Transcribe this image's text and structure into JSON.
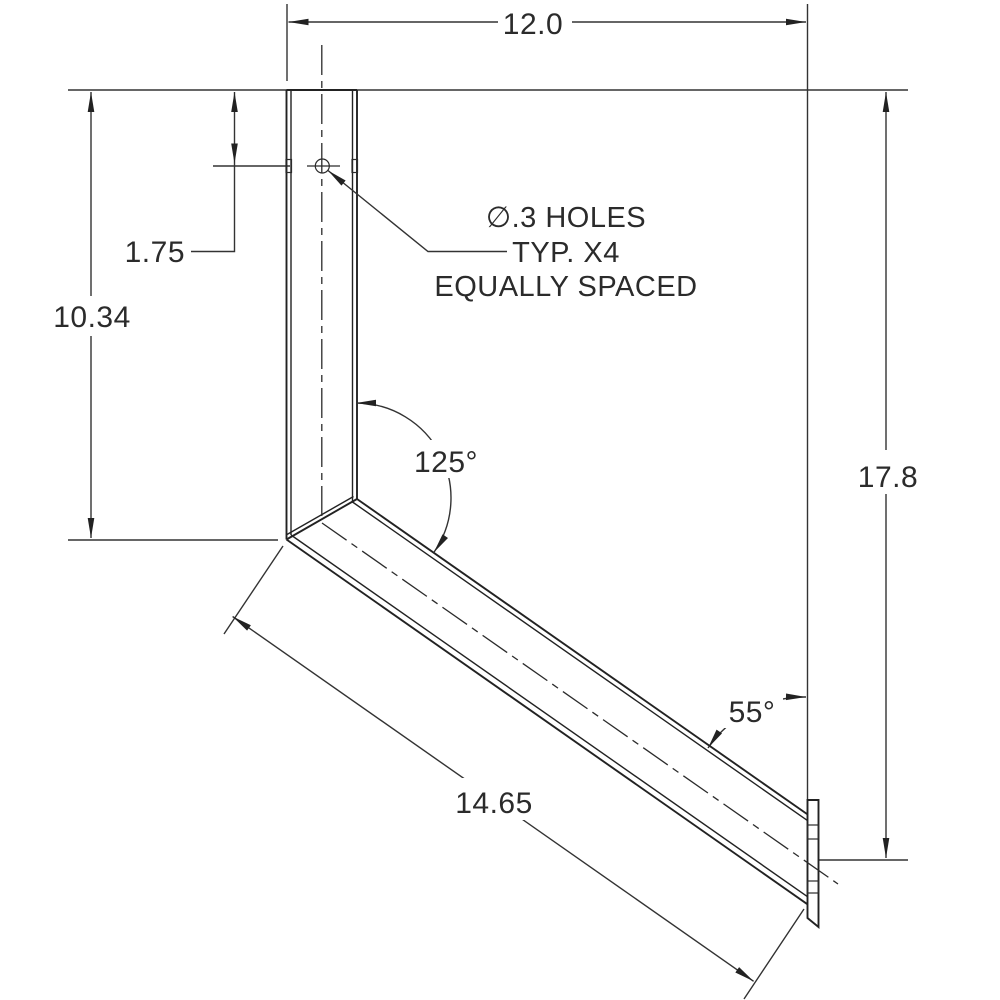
{
  "dims": {
    "width": "12.0",
    "left_height": "10.34",
    "hole_offset": "1.75",
    "total_height": "17.8",
    "diagonal_length": "14.65",
    "bend_angle": "125°",
    "end_angle": "55°"
  },
  "note": {
    "line1": "∅.3 HOLES",
    "line2": "TYP. X4",
    "line3": "EQUALLY SPACED"
  },
  "colors": {
    "line": "#2b2b2b",
    "background": "#ffffff"
  }
}
